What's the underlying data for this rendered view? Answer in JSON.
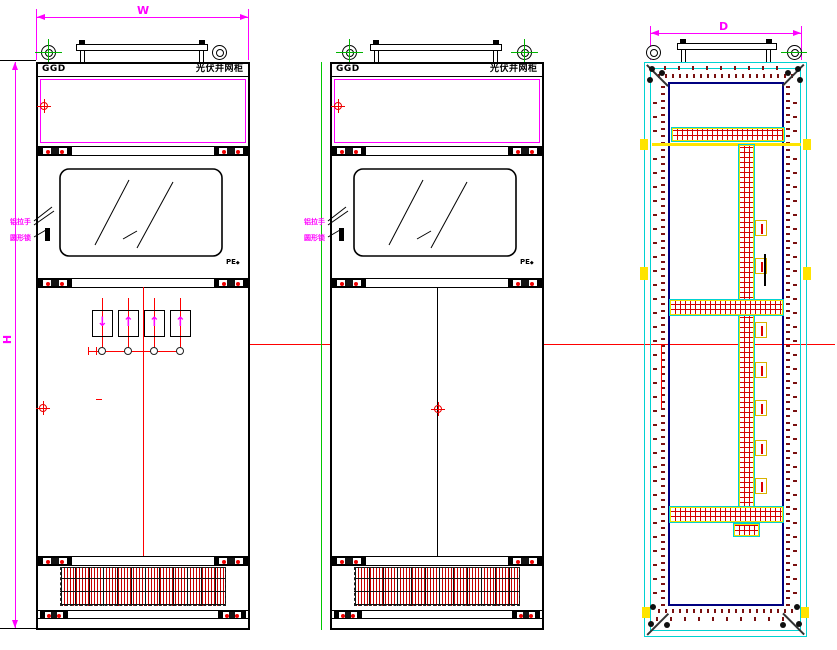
{
  "drawing_labels": {
    "dim_w": "W",
    "dim_h": "H",
    "dim_d": "D"
  },
  "cabinet": {
    "code": "GGD",
    "name": "光伏并网柜",
    "pe": "PE",
    "pe_symbol": "◆"
  },
  "callouts": {
    "handle": "铝拉手",
    "lock": "圆形锁"
  },
  "instruments": {
    "arrows": [
      "↓",
      "↑",
      "↑",
      "↑"
    ]
  },
  "colors": {
    "outline": "#000000",
    "dimension": "#ff00ff",
    "centerline": "#ff0000",
    "vent_louver": "#c80000",
    "rear_frame": "#00d2d2",
    "rear_inner": "#000080",
    "accent": "#ffe400",
    "hole_dots": "#7a1010",
    "eye_cross": "#00b400",
    "section_line": "#00c800"
  }
}
